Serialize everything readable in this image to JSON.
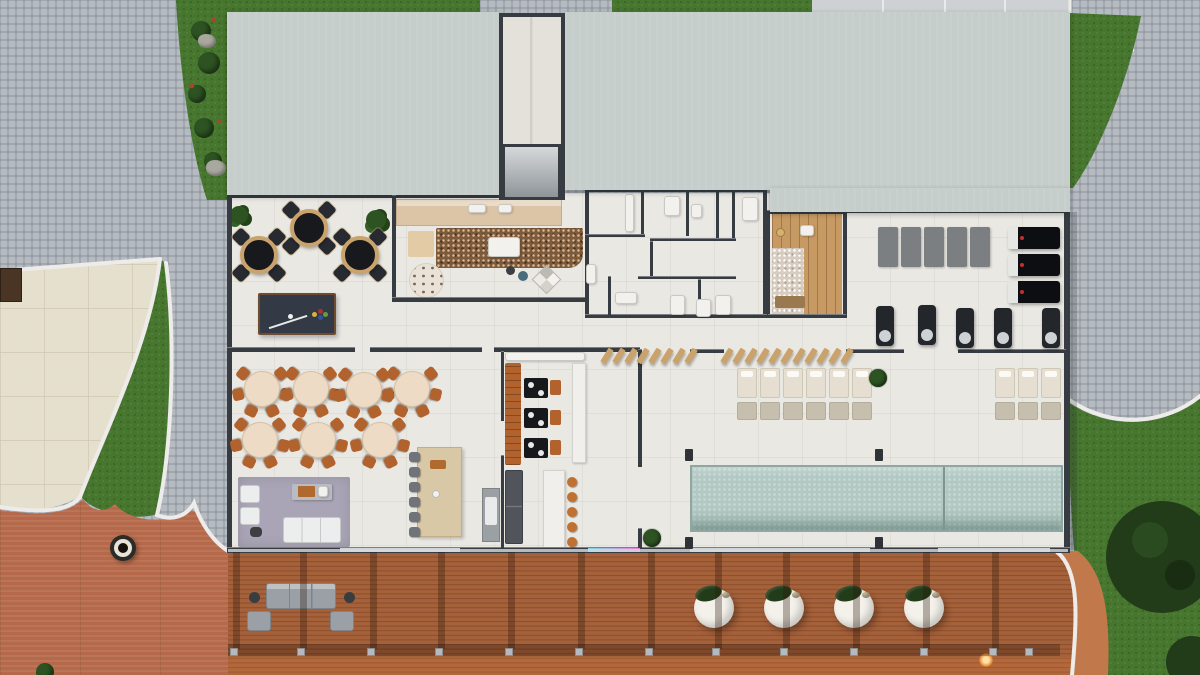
{
  "palette": {
    "cobble": "#b6bbc1",
    "cobbleJoint": "#979da5",
    "slab": "#cdd1d3",
    "grass": "#47762f",
    "bush": "#2d5322",
    "tree": "#223c1a",
    "roof": "#c6cecb",
    "wall": "#363c41",
    "floor": "#eae8e3",
    "plaza": "#e5dfcd",
    "terracotta": "#b5694a",
    "wood": "#a5613a",
    "woodLine": "#8c4e2d",
    "woodSun": "#c1794c",
    "pool": "#b2c9c3",
    "poolEdge": "#8fa7a2",
    "tan": "#c9a36b",
    "counterWood": "#dcc5a6",
    "carpet": "#7c5a3c",
    "lavender": "#a9a5b6",
    "tableTop": "#eedbc5",
    "chairOrange": "#b2622c",
    "bedTop": "#e6dfd1",
    "bedBase": "#c7bfae",
    "gymMat": "#7b7f82",
    "dark": "#17191d",
    "white": "#f2f1ed",
    "glass": "#ccd3d6",
    "saunaWood": "#c79a63",
    "pebble": "#d6ccc0"
  },
  "walls": [
    {
      "x": 227,
      "y": 193,
      "w": 276,
      "h": 5
    },
    {
      "x": 227,
      "y": 193,
      "w": 5,
      "h": 359
    },
    {
      "x": 392,
      "y": 195,
      "w": 4,
      "h": 107
    },
    {
      "x": 392,
      "y": 297,
      "w": 194,
      "h": 5
    },
    {
      "x": 585,
      "y": 188,
      "w": 182,
      "h": 4
    },
    {
      "x": 766,
      "y": 210,
      "w": 80,
      "h": 4
    },
    {
      "x": 843,
      "y": 208,
      "w": 227,
      "h": 5
    },
    {
      "x": 1064,
      "y": 210,
      "w": 6,
      "h": 342
    },
    {
      "x": 227,
      "y": 547,
      "w": 843,
      "h": 6
    },
    {
      "x": 227,
      "y": 347,
      "w": 128,
      "h": 5
    },
    {
      "x": 370,
      "y": 347,
      "w": 112,
      "h": 5
    },
    {
      "x": 494,
      "y": 347,
      "w": 146,
      "h": 5
    },
    {
      "x": 690,
      "y": 349,
      "w": 34,
      "h": 4
    },
    {
      "x": 846,
      "y": 349,
      "w": 58,
      "h": 4
    },
    {
      "x": 958,
      "y": 349,
      "w": 108,
      "h": 4
    },
    {
      "x": 638,
      "y": 349,
      "w": 4,
      "h": 118
    },
    {
      "x": 638,
      "y": 528,
      "w": 4,
      "h": 24
    },
    {
      "x": 501,
      "y": 351,
      "w": 3,
      "h": 70
    },
    {
      "x": 501,
      "y": 455,
      "w": 3,
      "h": 93
    },
    {
      "x": 766,
      "y": 210,
      "w": 4,
      "h": 108
    },
    {
      "x": 843,
      "y": 210,
      "w": 4,
      "h": 108
    },
    {
      "x": 768,
      "y": 314,
      "w": 78,
      "h": 4
    },
    {
      "x": 585,
      "y": 188,
      "w": 4,
      "h": 130
    },
    {
      "x": 763,
      "y": 188,
      "w": 4,
      "h": 130
    },
    {
      "x": 585,
      "y": 314,
      "w": 182,
      "h": 4
    },
    {
      "x": 641,
      "y": 188,
      "w": 3,
      "h": 48
    },
    {
      "x": 686,
      "y": 188,
      "w": 3,
      "h": 48
    },
    {
      "x": 716,
      "y": 188,
      "w": 3,
      "h": 52
    },
    {
      "x": 732,
      "y": 188,
      "w": 3,
      "h": 52
    },
    {
      "x": 585,
      "y": 234,
      "w": 60,
      "h": 3
    },
    {
      "x": 650,
      "y": 238,
      "w": 86,
      "h": 3
    },
    {
      "x": 650,
      "y": 241,
      "w": 3,
      "h": 38
    },
    {
      "x": 608,
      "y": 276,
      "w": 3,
      "h": 40
    },
    {
      "x": 638,
      "y": 276,
      "w": 98,
      "h": 3
    },
    {
      "x": 698,
      "y": 279,
      "w": 3,
      "h": 37
    }
  ],
  "glass_segments": [
    {
      "x": 340,
      "y": 548,
      "w": 120,
      "h": 4,
      "c": "#cdd4d7"
    },
    {
      "x": 588,
      "y": 548,
      "w": 52,
      "h": 4,
      "c": "linear-gradient(90deg,#7fd8e8,#e87fd8)"
    },
    {
      "x": 690,
      "y": 548,
      "w": 180,
      "h": 4,
      "c": "#cdd4d7"
    },
    {
      "x": 938,
      "y": 548,
      "w": 112,
      "h": 4,
      "c": "#cdd4d7"
    }
  ],
  "bath_fixtures": [
    {
      "x": 625,
      "y": 194,
      "w": 9,
      "h": 38
    },
    {
      "x": 664,
      "y": 196,
      "w": 16,
      "h": 20
    },
    {
      "x": 691,
      "y": 204,
      "w": 11,
      "h": 14
    },
    {
      "x": 742,
      "y": 197,
      "w": 16,
      "h": 24
    },
    {
      "x": 586,
      "y": 264,
      "w": 10,
      "h": 20
    },
    {
      "x": 615,
      "y": 292,
      "w": 22,
      "h": 12
    },
    {
      "x": 670,
      "y": 295,
      "w": 15,
      "h": 20
    },
    {
      "x": 696,
      "y": 299,
      "w": 15,
      "h": 18
    },
    {
      "x": 715,
      "y": 295,
      "w": 16,
      "h": 20
    }
  ],
  "poker_tables": [
    {
      "x": 259,
      "y": 255
    },
    {
      "x": 309,
      "y": 228
    },
    {
      "x": 360,
      "y": 255
    }
  ],
  "dining_tables": [
    {
      "x": 262,
      "y": 389
    },
    {
      "x": 311,
      "y": 389
    },
    {
      "x": 364,
      "y": 390
    },
    {
      "x": 412,
      "y": 389
    },
    {
      "x": 260,
      "y": 440
    },
    {
      "x": 318,
      "y": 440
    },
    {
      "x": 380,
      "y": 440
    }
  ],
  "island_stools": [
    {
      "x": 409,
      "y": 452
    },
    {
      "x": 409,
      "y": 467
    },
    {
      "x": 409,
      "y": 482
    },
    {
      "x": 409,
      "y": 497
    },
    {
      "x": 409,
      "y": 512
    },
    {
      "x": 409,
      "y": 527
    }
  ],
  "bar_tables": [
    {
      "x": 524,
      "y": 378
    },
    {
      "x": 524,
      "y": 408
    },
    {
      "x": 524,
      "y": 438
    }
  ],
  "bar_stools": [
    {
      "x": 567,
      "y": 477
    },
    {
      "x": 567,
      "y": 492
    },
    {
      "x": 567,
      "y": 507
    },
    {
      "x": 567,
      "y": 522
    },
    {
      "x": 567,
      "y": 537
    }
  ],
  "wood_slats": [
    {
      "x": 604,
      "y": 348
    },
    {
      "x": 616,
      "y": 348
    },
    {
      "x": 628,
      "y": 348
    },
    {
      "x": 640,
      "y": 348
    },
    {
      "x": 652,
      "y": 348
    },
    {
      "x": 664,
      "y": 348
    },
    {
      "x": 676,
      "y": 348
    },
    {
      "x": 688,
      "y": 348
    },
    {
      "x": 724,
      "y": 348
    },
    {
      "x": 736,
      "y": 348
    },
    {
      "x": 748,
      "y": 348
    },
    {
      "x": 760,
      "y": 348
    },
    {
      "x": 772,
      "y": 348
    },
    {
      "x": 784,
      "y": 348
    },
    {
      "x": 796,
      "y": 348
    },
    {
      "x": 808,
      "y": 348
    },
    {
      "x": 820,
      "y": 348
    },
    {
      "x": 832,
      "y": 348
    },
    {
      "x": 844,
      "y": 348
    }
  ],
  "spa_beds": [
    {
      "x": 737,
      "y": 368
    },
    {
      "x": 760,
      "y": 368
    },
    {
      "x": 783,
      "y": 368
    },
    {
      "x": 806,
      "y": 368
    },
    {
      "x": 829,
      "y": 368
    },
    {
      "x": 852,
      "y": 368
    },
    {
      "x": 995,
      "y": 368
    },
    {
      "x": 1018,
      "y": 368
    },
    {
      "x": 1041,
      "y": 368
    }
  ],
  "plants": [
    {
      "x": 878,
      "y": 378
    },
    {
      "x": 652,
      "y": 538
    }
  ],
  "gym_mats": [
    {
      "x": 878,
      "y": 227
    },
    {
      "x": 901,
      "y": 227
    },
    {
      "x": 924,
      "y": 227
    },
    {
      "x": 947,
      "y": 227
    },
    {
      "x": 970,
      "y": 227
    }
  ],
  "treadmills": [
    {
      "x": 1008,
      "y": 227
    },
    {
      "x": 1008,
      "y": 254
    },
    {
      "x": 1008,
      "y": 281
    }
  ],
  "gym_machines": [
    {
      "x": 876,
      "y": 306
    },
    {
      "x": 918,
      "y": 305
    },
    {
      "x": 956,
      "y": 308
    },
    {
      "x": 994,
      "y": 308
    },
    {
      "x": 1042,
      "y": 308
    }
  ],
  "glass_posts": [
    {
      "x": 685,
      "y": 449
    },
    {
      "x": 875,
      "y": 449
    },
    {
      "x": 685,
      "y": 537
    },
    {
      "x": 875,
      "y": 537
    }
  ],
  "deck_beams": [
    {
      "x": 233,
      "y": 552
    },
    {
      "x": 300,
      "y": 552
    },
    {
      "x": 370,
      "y": 552
    },
    {
      "x": 438,
      "y": 552
    },
    {
      "x": 508,
      "y": 552
    },
    {
      "x": 578,
      "y": 552
    },
    {
      "x": 648,
      "y": 552
    },
    {
      "x": 715,
      "y": 552
    },
    {
      "x": 783,
      "y": 552
    },
    {
      "x": 853,
      "y": 552
    },
    {
      "x": 923,
      "y": 552
    },
    {
      "x": 992,
      "y": 552
    }
  ],
  "deck_posts": [
    {
      "x": 230,
      "y": 648
    },
    {
      "x": 297,
      "y": 648
    },
    {
      "x": 367,
      "y": 648
    },
    {
      "x": 435,
      "y": 648
    },
    {
      "x": 505,
      "y": 648
    },
    {
      "x": 575,
      "y": 648
    },
    {
      "x": 645,
      "y": 648
    },
    {
      "x": 712,
      "y": 648
    },
    {
      "x": 780,
      "y": 648
    },
    {
      "x": 850,
      "y": 648
    },
    {
      "x": 920,
      "y": 648
    },
    {
      "x": 989,
      "y": 648
    },
    {
      "x": 1025,
      "y": 648
    }
  ],
  "tubs": [
    {
      "x": 714,
      "y": 608
    },
    {
      "x": 784,
      "y": 608
    },
    {
      "x": 854,
      "y": 608
    },
    {
      "x": 924,
      "y": 608
    }
  ],
  "bushes": [
    {
      "x": 191,
      "y": 21,
      "w": 20,
      "h": 20
    },
    {
      "x": 198,
      "y": 52,
      "w": 22,
      "h": 22
    },
    {
      "x": 188,
      "y": 85,
      "w": 18,
      "h": 18
    },
    {
      "x": 194,
      "y": 118,
      "w": 20,
      "h": 20
    },
    {
      "x": 204,
      "y": 152,
      "w": 18,
      "h": 18
    },
    {
      "x": 36,
      "y": 663,
      "w": 18,
      "h": 18
    }
  ],
  "rocks": [
    {
      "x": 198,
      "y": 34,
      "w": 18,
      "h": 14
    },
    {
      "x": 206,
      "y": 160,
      "w": 20,
      "h": 16
    }
  ],
  "flowers": [
    {
      "x": 212,
      "y": 18,
      "w": 4,
      "h": 4
    },
    {
      "x": 190,
      "y": 84,
      "w": 4,
      "h": 4
    },
    {
      "x": 218,
      "y": 120,
      "w": 3,
      "h": 3
    }
  ]
}
